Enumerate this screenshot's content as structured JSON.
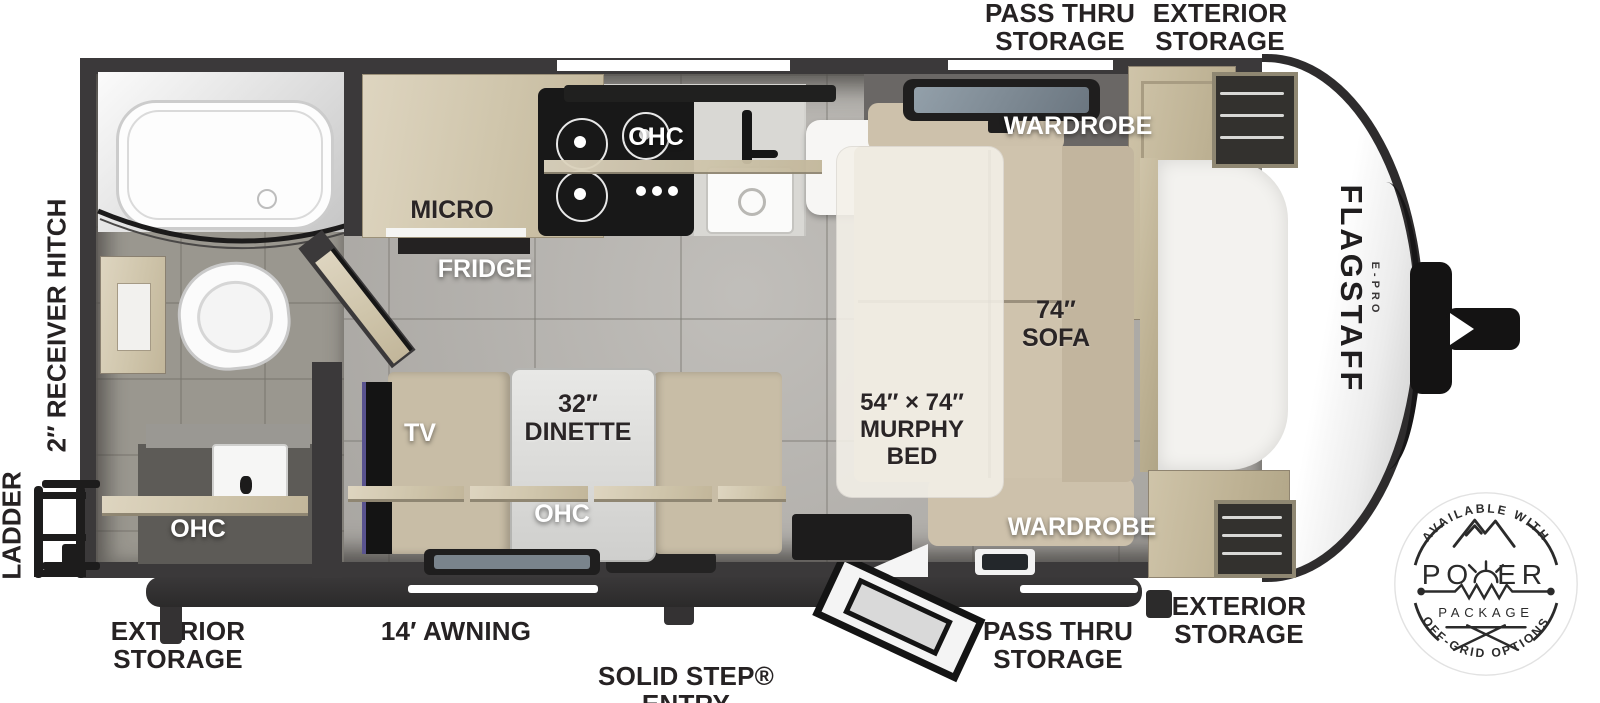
{
  "floorplan": {
    "exterior_labels": {
      "top_pass_thru_storage": "PASS THRU\nSTORAGE",
      "top_exterior_storage": "EXTERIOR\nSTORAGE",
      "receiver_hitch": "2″ RECEIVER HITCH",
      "ladder": "LADDER",
      "bottom_left_exterior_storage": "EXTERIOR\nSTORAGE",
      "awning": "14′ AWNING",
      "solid_step_entry": "SOLID STEP® ENTRY",
      "bottom_pass_thru_storage": "PASS THRU\nSTORAGE",
      "bottom_right_exterior_storage": "EXTERIOR\nSTORAGE"
    },
    "interior_labels": {
      "micro": "MICRO",
      "fridge": "FRIDGE",
      "kitchen_ohc": "OHC",
      "wardrobe_top": "WARDROBE",
      "sofa": "74″\nSOFA",
      "murphy_bed": "54″ × 74″\nMURPHY\nBED",
      "wardrobe_bottom": "WARDROBE",
      "tv": "TV",
      "dinette": "32″\nDINETTE",
      "dinette_ohc": "OHC",
      "bath_ohc": "OHC"
    },
    "brand": {
      "name": "FLAGSTAFF",
      "sub": "E-PRO"
    },
    "badge": {
      "top_arc": "AVAILABLE WITH",
      "power_left": "PO",
      "power_right": "ER",
      "package": "PACKAGE",
      "bottom_arc": "OFF-GRID OPTIONS"
    },
    "colors": {
      "wall": "#3b393a",
      "floor": "#b3b0ab",
      "wood": "#d6ccb4",
      "sofa": "#cfc3ad",
      "label_dark": "#262223",
      "label_light": "#ffffff"
    }
  }
}
